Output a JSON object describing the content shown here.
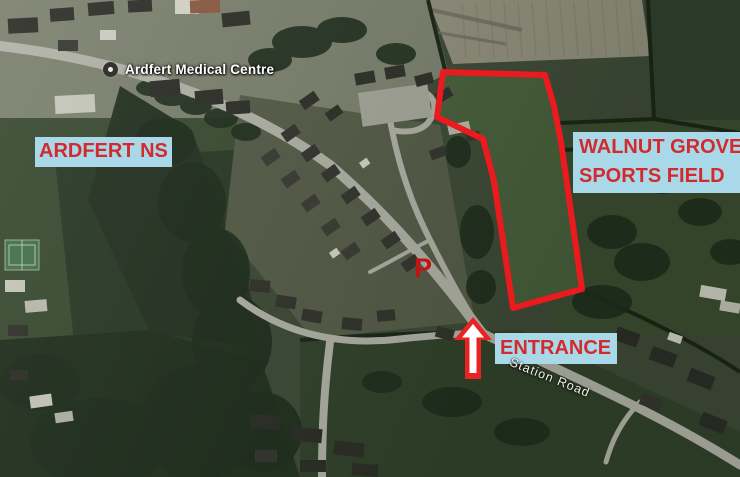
{
  "map": {
    "place_label": "Ardfert Medical Centre",
    "road_label": "Station Road"
  },
  "annotations": {
    "school_label": "ARDFERT NS",
    "sports_field_label_line1": "WALNUT GROVE",
    "sports_field_label_line2": "SPORTS FIELD",
    "entrance_label": "ENTRANCE",
    "parking_label": "P",
    "field_outline_points": "443,72 545,75 554,106 561,142 582,289 513,308 494,181 483,139 437,117",
    "colors": {
      "label_background": "#a9d8e8",
      "label_text": "#d32a2e",
      "field_outline_red": "#ea1a1e",
      "arrow_red": "#e82322",
      "parking_red": "#c61113"
    },
    "icons": {
      "place_marker": "dot-circle",
      "entrance_arrow": "up-arrow"
    }
  }
}
